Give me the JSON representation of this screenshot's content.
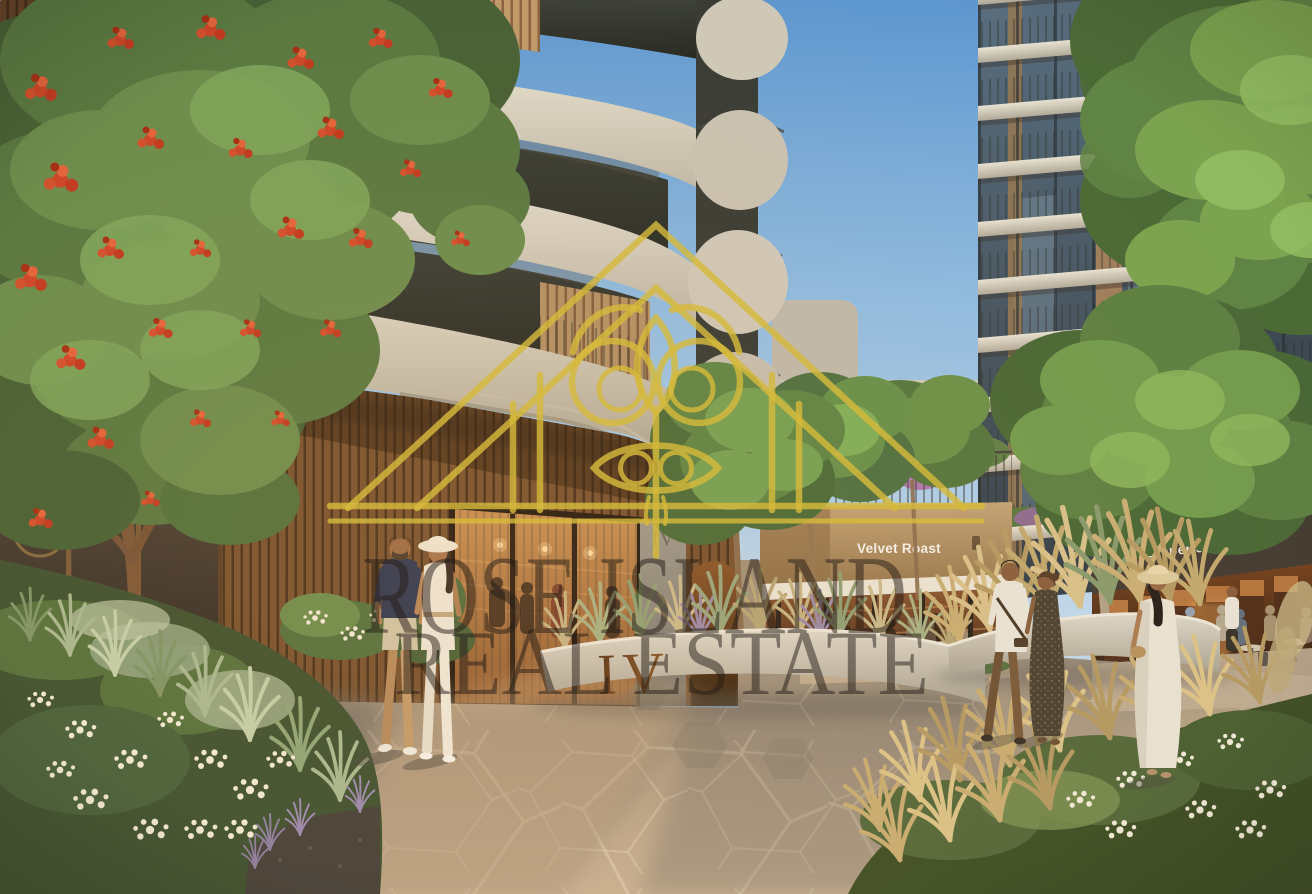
{
  "storefronts": {
    "velvet_roast_sign": "Velvet Roast",
    "ember_oak_sign": "Ember & Oak",
    "sign_text_color": "#f2efe6"
  },
  "building": {
    "wall_numeral": "IV",
    "planter_numeral": "IV"
  },
  "watermark": {
    "brand_line1": "ROSE ISLAND",
    "brand_line2": "REAL ESTATE",
    "logo_icon": "house-tulip-logo",
    "gold_color": "#d6b93c",
    "text_color": "#241c15"
  },
  "palette": {
    "sky_top": "#619ace",
    "sky_horizon": "#c9def0",
    "concrete_cream": "#ddd6c6",
    "bronze_wood": "#8a6038",
    "plaza_light": "#c4ad8e",
    "plaza_shadow": "#6f6a62",
    "foliage_green": "#5d7a42",
    "flame_red": "#cc4527",
    "bougainvillea": "#a05a9a"
  }
}
